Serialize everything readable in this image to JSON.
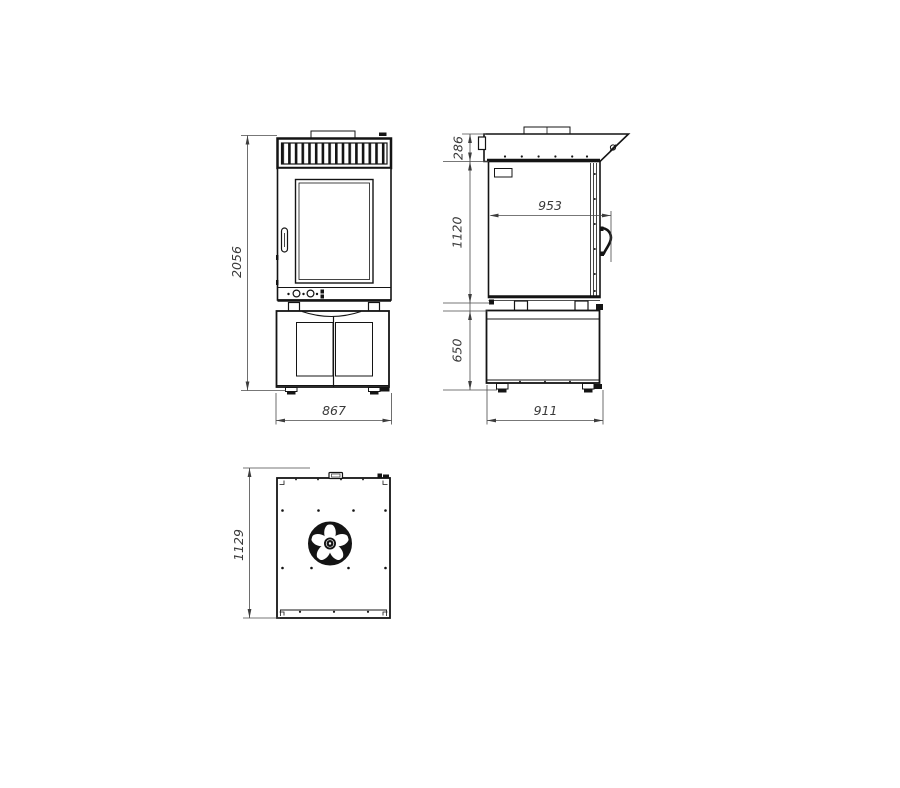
{
  "drawing": {
    "colors": {
      "line": "#141414",
      "dimension": "#3a3a3a",
      "background": "#ffffff"
    },
    "views": {
      "front": {
        "height": "2056",
        "width": "867"
      },
      "side": {
        "hood_height": "286",
        "oven_height": "1120",
        "stand_height": "650",
        "inner_depth": "953",
        "total_depth": "911"
      },
      "top": {
        "depth": "1129"
      }
    }
  }
}
